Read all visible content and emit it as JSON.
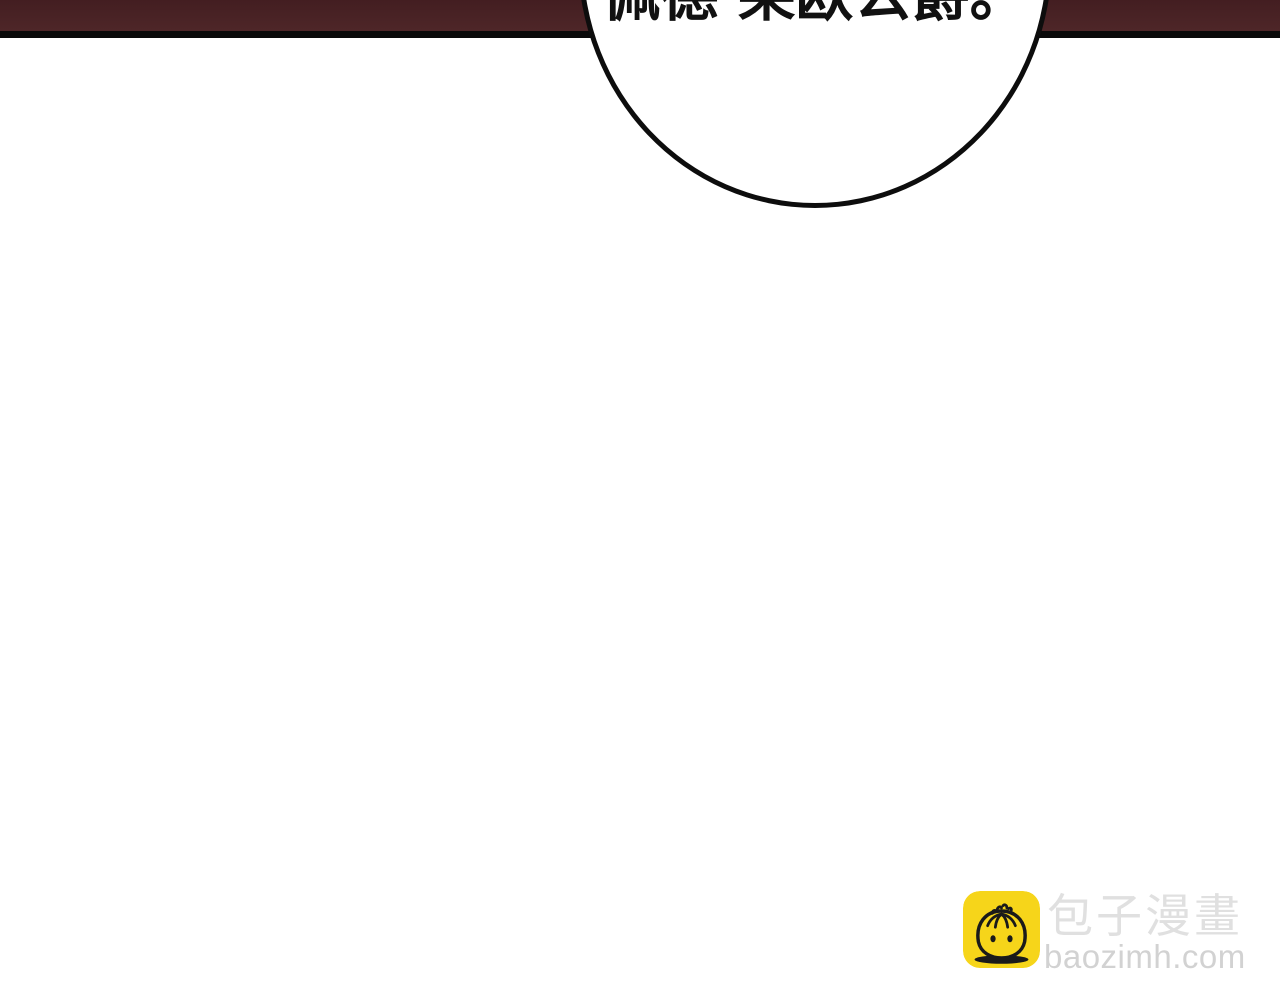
{
  "comic_page": {
    "speech_bubble": {
      "text": "佩德·莱欧公爵。"
    },
    "watermark": {
      "icon": "baozi-bun-icon",
      "brand_cn": "包子漫畫",
      "brand_url": "baozimh.com"
    }
  },
  "colors": {
    "band_maroon": "#4a2225",
    "band_border": "#0a0a0a",
    "bubble_stroke": "#0d0d0d",
    "bubble_fill": "#ffffff",
    "text_black": "#111111",
    "logo_yellow": "#f6d51a",
    "logo_line": "#1a1a1a",
    "brand_text_gray": "#e0e0e0",
    "url_text_gray": "#d2d2d2"
  }
}
